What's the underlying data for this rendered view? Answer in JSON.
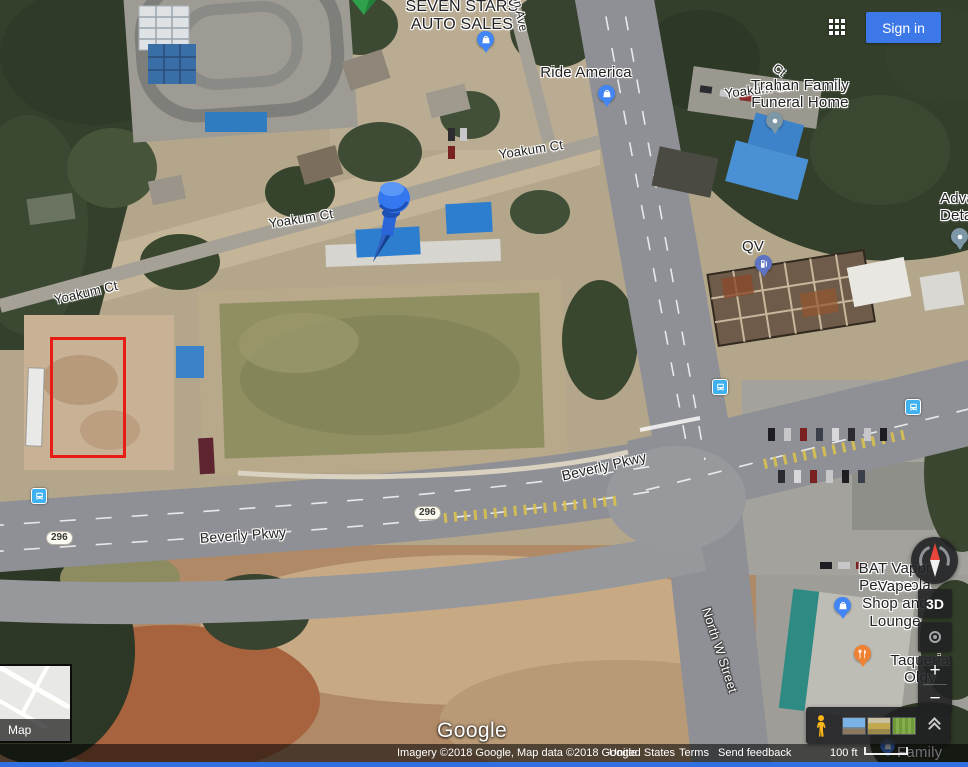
{
  "topbar": {
    "signin_label": "Sign in"
  },
  "controls": {
    "threed_label": "3D",
    "zoom_in_label": "+",
    "zoom_out_label": "−"
  },
  "inset": {
    "label": "Map"
  },
  "watermark": "Google",
  "attribution": {
    "imagery": "Imagery ©2018 Google, Map data ©2018 Google",
    "country": "United States",
    "terms": "Terms",
    "feedback": "Send feedback",
    "scale": "100 ft"
  },
  "annotation": {
    "x": 50,
    "y": 337,
    "w": 76,
    "h": 121,
    "color": "#e81b15"
  },
  "map": {
    "labels": [
      {
        "name": "label-seven-stars-auto-sales",
        "text": "SEVEN STARS\nAUTO SALES",
        "x": 462,
        "y": -2,
        "rot": 0,
        "size": 16,
        "weight": 500
      },
      {
        "name": "label-ride-america",
        "text": "Ride America",
        "x": 586,
        "y": 64,
        "size": 15,
        "weight": 500
      },
      {
        "name": "label-yoakum-ct-fragment",
        "text": "Yoakum Ct",
        "x": 757,
        "y": 83,
        "rot": -7,
        "size": 13
      },
      {
        "name": "label-trahan-funeral-home",
        "text": "Trahan Family\nFuneral Home",
        "x": 800,
        "y": 77,
        "size": 15,
        "weight": 500,
        "z": 5
      },
      {
        "name": "label-ct-fragment",
        "text": "Ct",
        "x": 779,
        "y": 64,
        "rot": 38,
        "size": 12
      },
      {
        "name": "label-on-ave",
        "text": "on Ave",
        "x": 519,
        "y": 6,
        "rot": 78,
        "size": 12
      },
      {
        "name": "label-yoakum-ct-1",
        "text": "Yoakum Ct",
        "x": 86,
        "y": 286,
        "rot": -13,
        "size": 13
      },
      {
        "name": "label-yoakum-ct-2",
        "text": "Yoakum Ct",
        "x": 301,
        "y": 212,
        "rot": -9,
        "size": 13
      },
      {
        "name": "label-yoakum-ct-3",
        "text": "Yoakum Ct",
        "x": 531,
        "y": 143,
        "rot": -9,
        "size": 13
      },
      {
        "name": "label-qv",
        "text": "QV",
        "x": 753,
        "y": 238,
        "size": 15,
        "weight": 500
      },
      {
        "name": "label-advance-detailing",
        "text": "Adva\nDeta",
        "x": 940,
        "y": 190,
        "size": 15,
        "weight": 500,
        "anchor": "left"
      },
      {
        "name": "label-beverly-pkwy-1",
        "text": "Beverly Pkwy",
        "x": 243,
        "y": 527,
        "rot": -4,
        "size": 14,
        "weight": 500
      },
      {
        "name": "label-beverly-pkwy-2",
        "text": "Beverly Pkwy",
        "x": 604,
        "y": 458,
        "rot": -13,
        "size": 14,
        "weight": 500
      },
      {
        "name": "label-north-w-street",
        "text": "North W Street",
        "x": 719,
        "y": 643,
        "rot": 72,
        "size": 13,
        "style": "white",
        "weight": 500
      },
      {
        "name": "label-bat-vapor-line1",
        "text": "BAT Vapor Pensacola",
        "x": 895,
        "y": 560,
        "size": 15,
        "weight": 500
      },
      {
        "name": "label-bat-vapor-line2",
        "text": "Vape Shop and Lounge",
        "x": 895,
        "y": 578,
        "size": 15,
        "weight": 500
      },
      {
        "name": "label-taqueria",
        "text": "Taqueria Olgy",
        "x": 920,
        "y": 652,
        "size": 15,
        "weight": 500
      },
      {
        "name": "label-family-dollar",
        "text": "Family Dollar",
        "x": 897,
        "y": 744,
        "size": 15,
        "style": "white",
        "weight": 500,
        "anchor": "left"
      }
    ],
    "shields": [
      {
        "label": "296",
        "x": 46,
        "y": 531
      },
      {
        "label": "296",
        "x": 414,
        "y": 506
      }
    ],
    "pins": [
      {
        "name": "marker-green",
        "type": "green",
        "x": 351,
        "y": 0
      },
      {
        "name": "pin-seven-stars",
        "type": "bag",
        "x": 486,
        "y": 31,
        "color": "#4285f4"
      },
      {
        "name": "pin-ride-america",
        "type": "bag",
        "x": 607,
        "y": 85,
        "color": "#4285f4"
      },
      {
        "name": "pin-funeral-home",
        "type": "dot",
        "x": 775,
        "y": 112,
        "color": "#7d97a6"
      },
      {
        "name": "pin-map-pushpin",
        "type": "pushpin",
        "x": 390,
        "y": 176
      },
      {
        "name": "pin-qv-gas",
        "type": "fuel",
        "x": 764,
        "y": 255,
        "color": "#5e74c2"
      },
      {
        "name": "pin-advance-detailing",
        "type": "dot",
        "x": 960,
        "y": 228,
        "color": "#7d97a6"
      },
      {
        "name": "pin-bat-vapor",
        "type": "bag",
        "x": 843,
        "y": 597,
        "color": "#4285f4"
      },
      {
        "name": "pin-taqueria",
        "type": "restaurant",
        "x": 863,
        "y": 645,
        "color": "#ef8232"
      },
      {
        "name": "pin-family-dollar",
        "type": "bag",
        "x": 888,
        "y": 737,
        "color": "#4285f4",
        "scale": 0.85
      },
      {
        "name": "bus-stop-1",
        "type": "bus",
        "x": 39,
        "y": 488,
        "color": "#3fb0f0"
      },
      {
        "name": "bus-stop-2",
        "type": "bus",
        "x": 720,
        "y": 379,
        "color": "#3fb0f0"
      },
      {
        "name": "bus-stop-3",
        "type": "bus",
        "x": 913,
        "y": 399,
        "color": "#3fb0f0"
      }
    ]
  }
}
